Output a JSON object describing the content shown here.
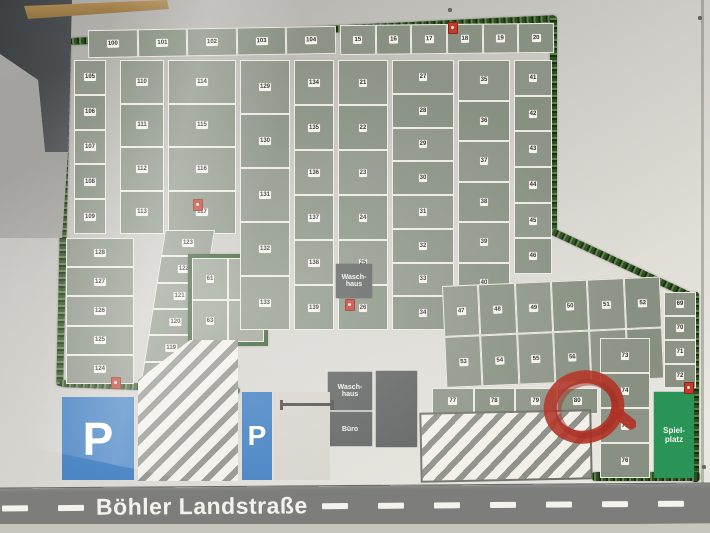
{
  "road": {
    "name": "Böhler Landstraße",
    "dashes_left": 2,
    "dashes_right": 8
  },
  "parking": {
    "label": "P"
  },
  "buildings": {
    "waschhaus_top": "Wasch-\nhaus",
    "waschhaus_bottom": "Wasch-\nhaus",
    "buero": "Büro"
  },
  "playground": {
    "label": "Spiel-\nplatz"
  },
  "icons": {
    "fire_extinguisher": "fire-extinguisher-icon",
    "annotation": "red-circle-annotation",
    "barrier": "entrance-barrier-icon"
  },
  "colors": {
    "plot_green": "#8d9487",
    "hedge_green": "#35582c",
    "parking_blue": "#3c7cc0",
    "playground_green": "#2a9457",
    "building_gray": "#5c5f5e",
    "road_gray": "#7d7d7b",
    "marker_red": "#bf3b2d",
    "annotation_red": "#b23224"
  },
  "plots": {
    "top_row_west": [
      "100",
      "101",
      "102",
      "103",
      "104"
    ],
    "top_row_east": [
      "15",
      "16",
      "17",
      "18",
      "19",
      "20"
    ],
    "tl_col_a": [
      "105",
      "106",
      "107",
      "108",
      "109"
    ],
    "tl_col_b": [
      "110",
      "111",
      "112",
      "113"
    ],
    "tl_col_c": [
      "114",
      "115",
      "116",
      "117"
    ],
    "left_col_lower": [
      "128",
      "127",
      "126",
      "125",
      "124"
    ],
    "diagonal_strip": [
      "123",
      "122",
      "121",
      "120",
      "119",
      "118"
    ],
    "hedged_block": [
      "61",
      "62",
      "63",
      "64"
    ],
    "center_col_a": [
      "129",
      "130",
      "131",
      "132",
      "133"
    ],
    "center_col_b": [
      "134",
      "135",
      "136",
      "137",
      "138",
      "139"
    ],
    "east_col_1": [
      "21",
      "22",
      "23",
      "24",
      "25",
      "26"
    ],
    "east_col_2": [
      "27",
      "28",
      "29",
      "30",
      "31",
      "32",
      "33",
      "34"
    ],
    "east_col_3": [
      "35",
      "36",
      "37",
      "38",
      "39",
      "40"
    ],
    "east_col_4": [
      "41",
      "42",
      "43",
      "44",
      "45",
      "46"
    ],
    "se_row_1": [
      "47",
      "48",
      "49",
      "50",
      "51",
      "52"
    ],
    "se_row_2": [
      "53",
      "54",
      "55",
      "56",
      "57",
      "58"
    ],
    "se_right_col": [
      "69",
      "70",
      "71",
      "72"
    ],
    "br_col": [
      "73",
      "74",
      "75",
      "76"
    ],
    "road_row": [
      "77",
      "78",
      "79",
      "80"
    ]
  }
}
